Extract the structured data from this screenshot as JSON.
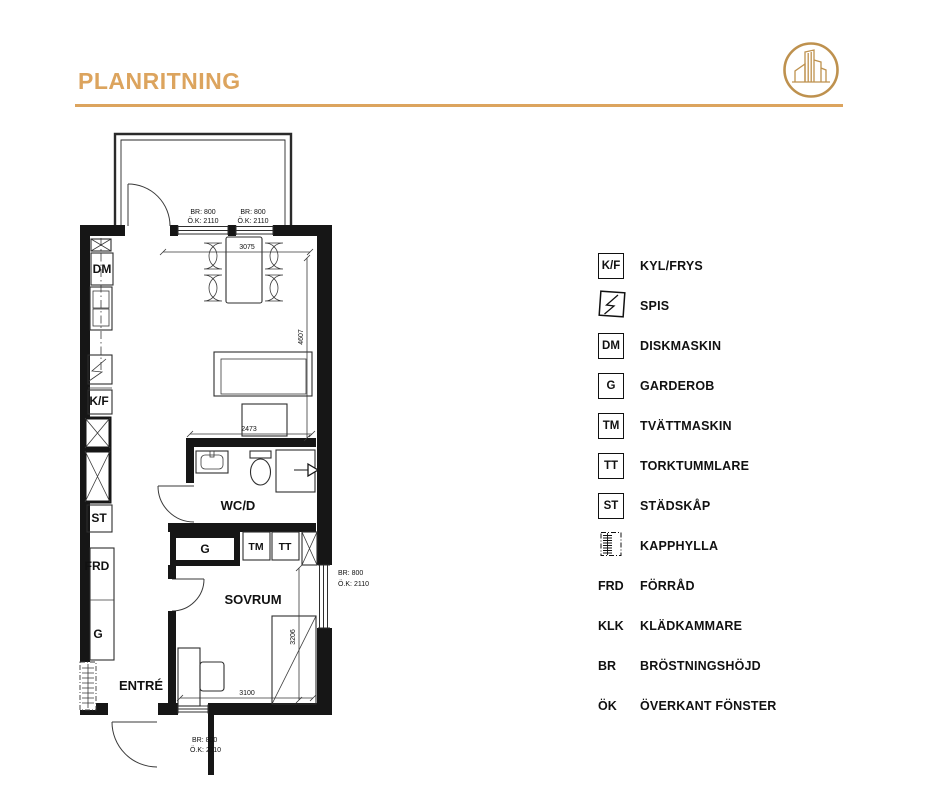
{
  "header": {
    "title": "PLANRITNING"
  },
  "colors": {
    "accent_gold": "#DCA45E",
    "line_black": "#161616"
  },
  "plan": {
    "room_labels": {
      "wcd": "WC/D",
      "sovrum": "SOVRUM",
      "entre": "ENTRÉ"
    },
    "fixture_labels": {
      "dm": "DM",
      "kf": "K/F",
      "st": "ST",
      "frd": "FRD",
      "g_hall": "G",
      "g_sovrum": "G",
      "tm": "TM",
      "tt": "TT"
    },
    "dimensions": {
      "kitchen_width": "3075",
      "living_height": "4607",
      "wc_width": "2473",
      "sovrum_height": "3206",
      "sovrum_width": "3100"
    },
    "windows": {
      "top_left": {
        "br": "BR: 800",
        "ok": "Ö.K: 2110"
      },
      "top_right": {
        "br": "BR: 800",
        "ok": "Ö.K: 2110"
      },
      "right": {
        "br": "BR: 800",
        "ok": "Ö.K: 2110"
      },
      "bottom": {
        "br": "BR: 800",
        "ok": "Ö.K: 2110"
      }
    }
  },
  "legend": {
    "items": [
      {
        "abbr": "K/F",
        "style": "box",
        "label": "KYL/FRYS"
      },
      {
        "icon": "spis-icon",
        "style": "icon",
        "label": "SPIS"
      },
      {
        "abbr": "DM",
        "style": "box",
        "label": "DISKMASKIN"
      },
      {
        "abbr": "G",
        "style": "box",
        "label": "GARDEROB"
      },
      {
        "abbr": "TM",
        "style": "box",
        "label": "TVÄTTMASKIN"
      },
      {
        "abbr": "TT",
        "style": "box",
        "label": "TORKTUMMLARE"
      },
      {
        "abbr": "ST",
        "style": "box",
        "label": "STÄDSKÅP"
      },
      {
        "icon": "kapphylla-icon",
        "style": "icon",
        "label": "KAPPHYLLA"
      },
      {
        "abbr": "FRD",
        "style": "text",
        "label": "FÖRRÅD"
      },
      {
        "abbr": "KLK",
        "style": "text",
        "label": "KLÄDKAMMARE"
      },
      {
        "abbr": "BR",
        "style": "text",
        "label": "BRÖSTNINGSHÖJD"
      },
      {
        "abbr": "ÖK",
        "style": "text",
        "label": "ÖVERKANT FÖNSTER"
      }
    ]
  }
}
